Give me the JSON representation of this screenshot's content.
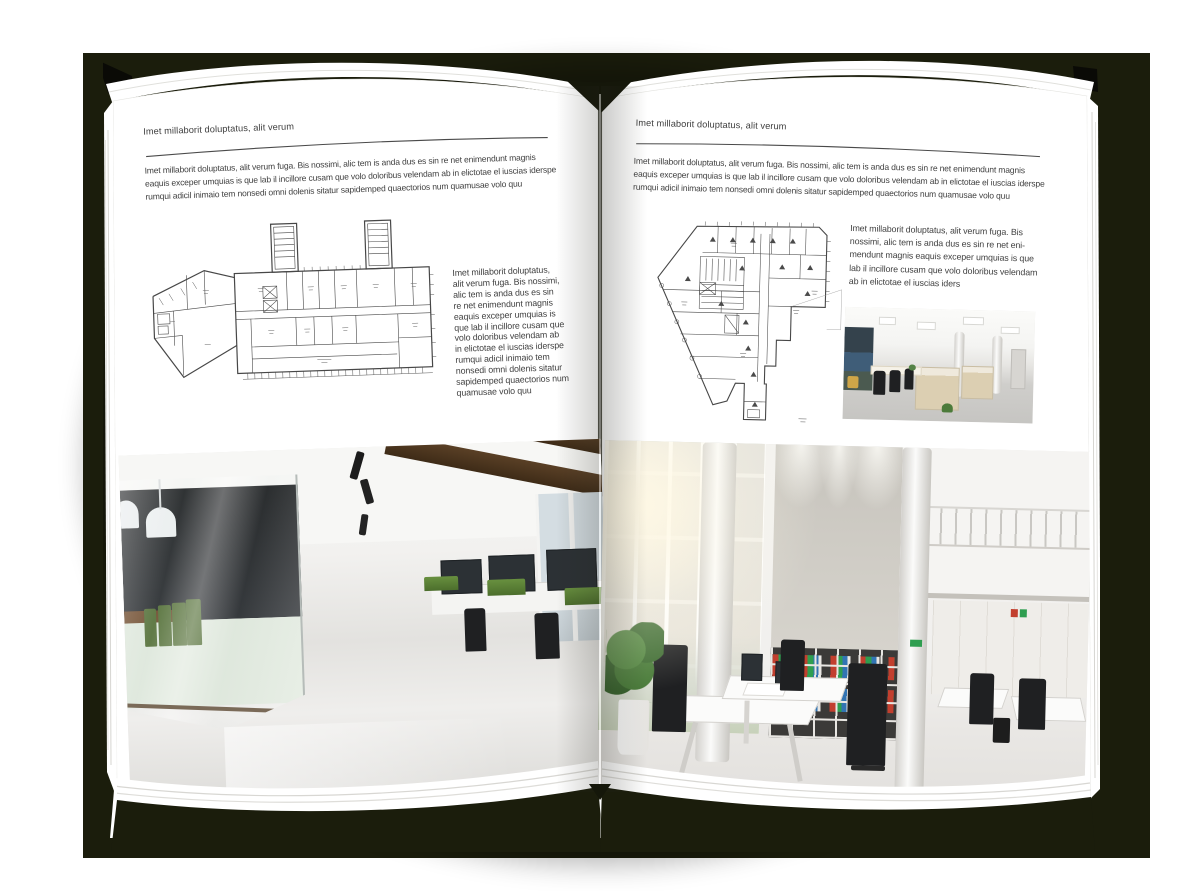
{
  "colors": {
    "backdrop": "#1b1d0c",
    "page": "#ffffff",
    "text": "#404040",
    "header_rule": "#4a4a4a",
    "plan_lines": "#474747",
    "photo_left_wood": "#6f4c2d",
    "photo_left_chair_green": "#4f6b31",
    "photo_right_binder_red": "#c23f2e",
    "photo_right_binder_green": "#2f9e50",
    "photo_right_binder_blue": "#3274b3"
  },
  "left_page": {
    "header": "Imet millaborit doluptatus, alit verum",
    "intro_lines": [
      "Imet millaborit doluptatus, alit verum fuga. Bis nossimi, alic tem is anda dus es sin re net enimendunt magnis",
      "eaquis exceper umquias is que lab il incillore cusam que volo doloribus velendam ab in elictotae el iuscias iderspe",
      "rumqui adicil inimaio tem nonsedi omni dolenis sitatur sapidemped quaectorios num quamusae volo quu"
    ],
    "side_text_lines": [
      "Imet millaborit doluptatus,",
      "alit verum fuga. Bis nossimi,",
      "alic tem is anda dus es sin",
      "re net enimendunt magnis",
      "eaquis exceper umquias is",
      "que lab il incillore cusam que",
      "volo doloribus velendam ab",
      "in elictotae el iuscias iderspe",
      "rumqui adicil inimaio tem",
      "nonsedi omni dolenis sitatur",
      "sapidemped quaectorios num",
      "quamusae volo quu"
    ]
  },
  "right_page": {
    "header": "Imet millaborit doluptatus, alit verum",
    "intro_lines": [
      "Imet millaborit doluptatus, alit verum fuga. Bis nossimi, alic tem is anda dus es sin re net enimendunt magnis",
      "eaquis exceper umquias is que lab il incillore cusam que volo doloribus velendam ab in elictotae el iuscias iderspe",
      "rumqui adicil inimaio tem nonsedi omni dolenis sitatur sapidemped quaectorios num quamusae volo quu"
    ],
    "body_lines": [
      "Imet millaborit doluptatus, alit verum fuga. Bis",
      "nossimi, alic tem is anda dus es sin re net eni-",
      "mendunt magnis eaquis exceper umquias is que",
      "lab il incillore cusam que volo doloribus velendam",
      "ab in elictotae el iuscias iders"
    ]
  }
}
